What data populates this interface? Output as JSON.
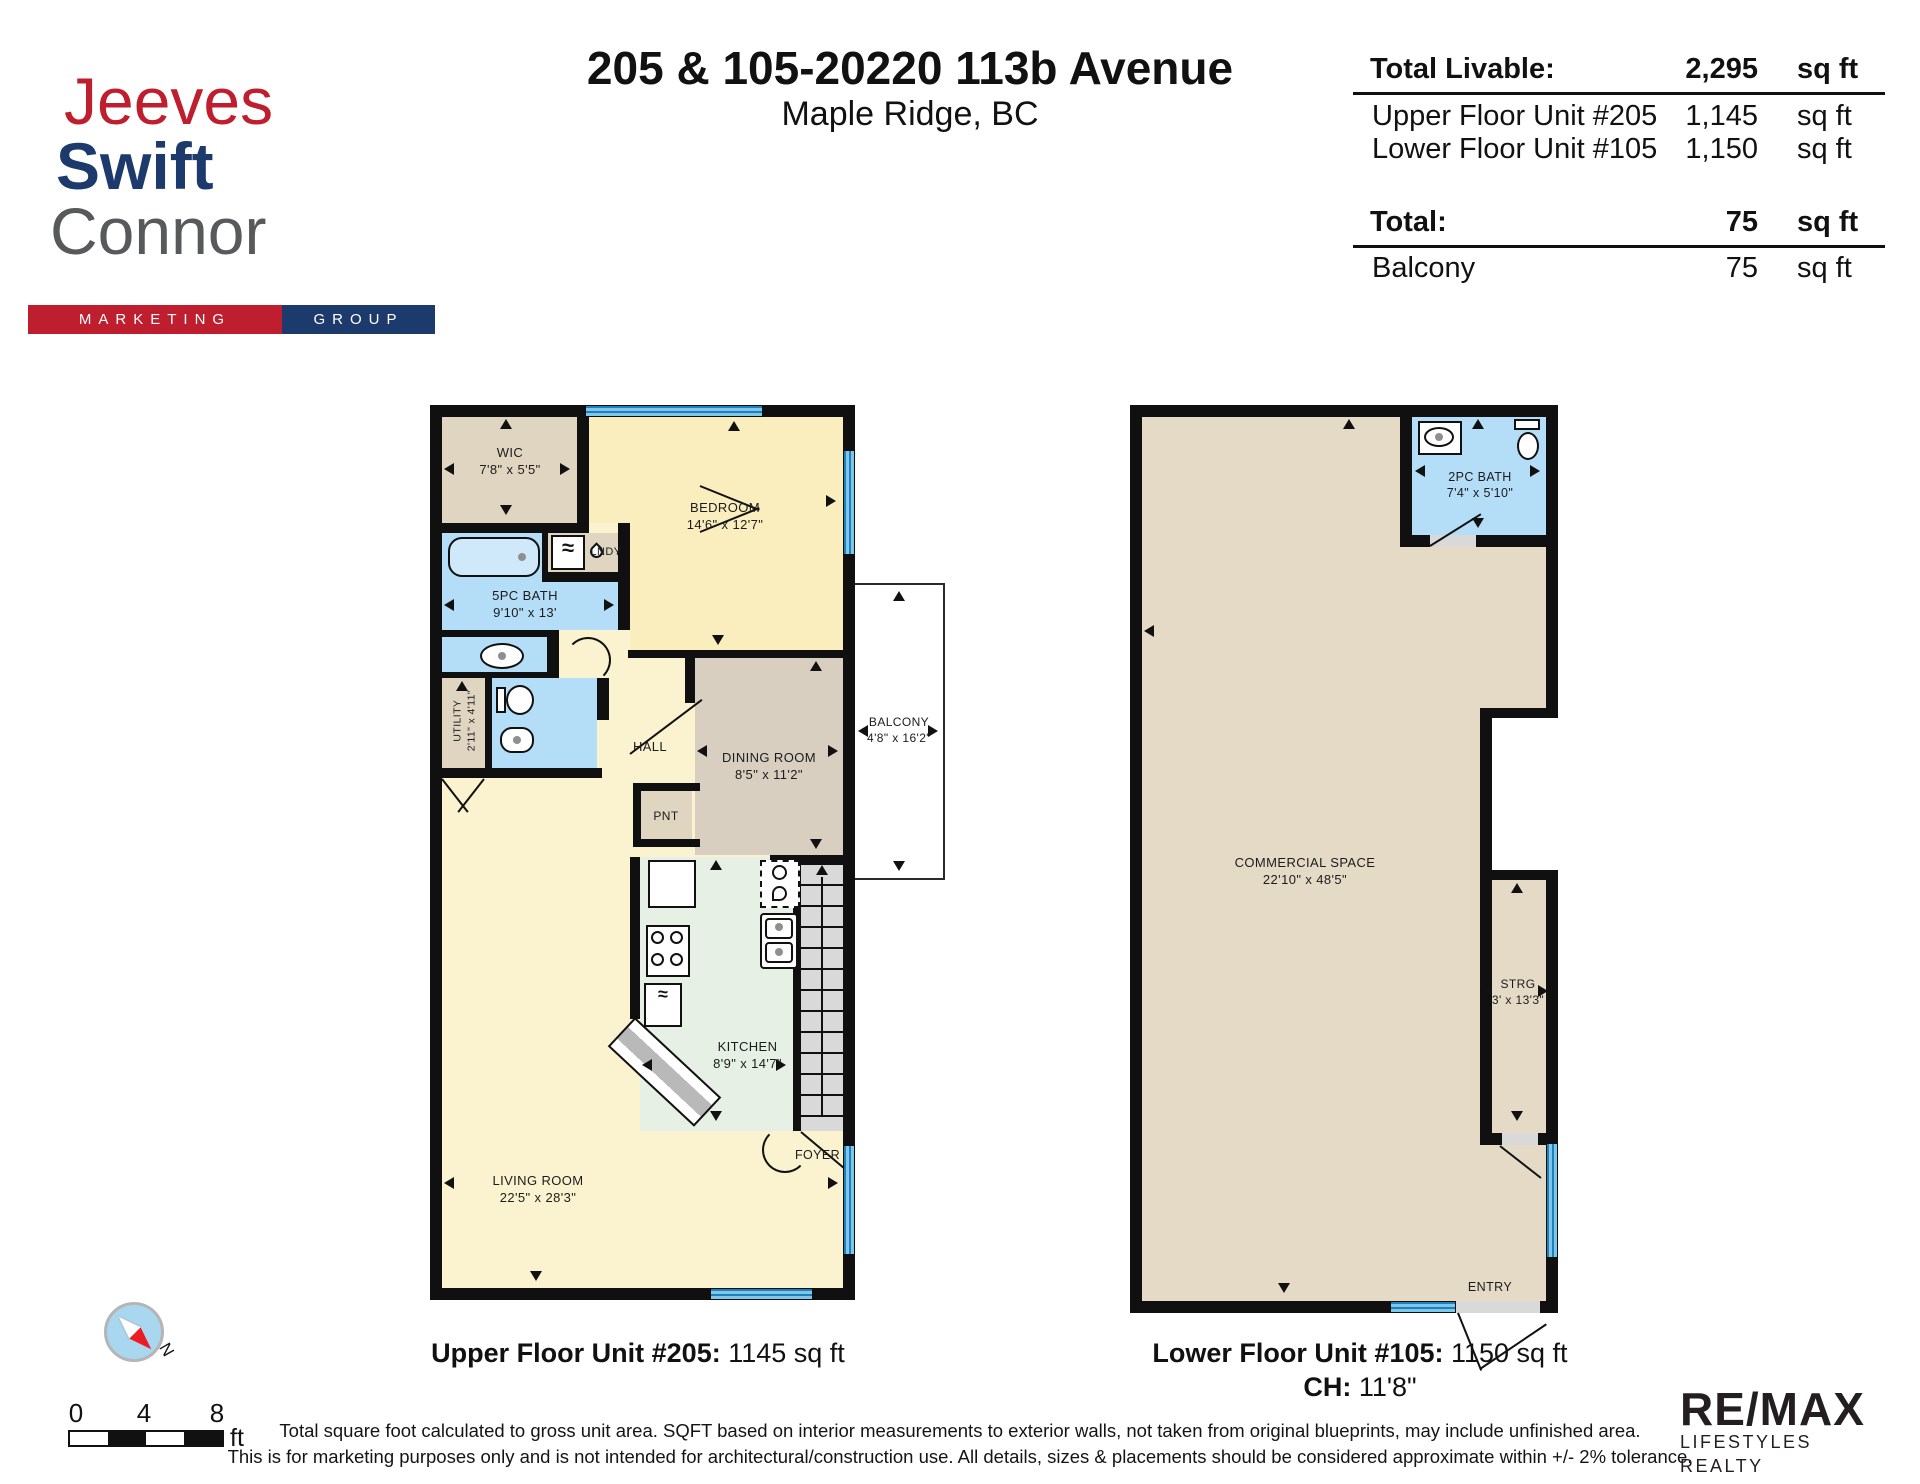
{
  "logo": {
    "line1": "Jeeves",
    "line2": "Swift",
    "line3": "Connor",
    "banner_left": "MARKETING",
    "banner_right": "GROUP"
  },
  "header": {
    "address": "205 & 105-20220 113b Avenue",
    "city": "Maple Ridge, BC"
  },
  "area_table": {
    "rows": [
      {
        "label": "Total Livable:",
        "value": "2,295",
        "unit": "sq ft"
      },
      {
        "label": "Upper Floor Unit #205",
        "value": "1,145",
        "unit": "sq ft"
      },
      {
        "label": "Lower Floor Unit #105",
        "value": "1,150",
        "unit": "sq ft"
      },
      {
        "label": "Total:",
        "value": "75",
        "unit": "sq ft"
      },
      {
        "label": "Balcony",
        "value": "75",
        "unit": "sq ft"
      }
    ]
  },
  "upper_plan": {
    "rooms": {
      "wic": {
        "name": "WIC",
        "dims": "7'8\" x 5'5\""
      },
      "bedroom": {
        "name": "BEDROOM",
        "dims": "14'6\" x 12'7\""
      },
      "bath5": {
        "name": "5PC BATH",
        "dims": "9'10\" x 13'"
      },
      "lndy": {
        "name": "LNDY"
      },
      "utility": {
        "name": "UTILITY",
        "dims": "2'11\" x 4'11\""
      },
      "hall": {
        "name": "HALL"
      },
      "dining": {
        "name": "DINING ROOM",
        "dims": "8'5\" x 11'2\""
      },
      "balcony": {
        "name": "BALCONY",
        "dims": "4'8\" x 16'2\""
      },
      "pnt": {
        "name": "PNT"
      },
      "kitchen": {
        "name": "KITCHEN",
        "dims": "8'9\" x 14'7\""
      },
      "foyer": {
        "name": "FOYER"
      },
      "living": {
        "name": "LIVING ROOM",
        "dims": "22'5\" x 28'3\""
      }
    },
    "caption": {
      "bold": "Upper Floor Unit #205:",
      "text": " 1145 sq ft"
    }
  },
  "lower_plan": {
    "rooms": {
      "commercial": {
        "name": "COMMERCIAL SPACE",
        "dims": "22'10\" x 48'5\""
      },
      "bath2": {
        "name": "2PC BATH",
        "dims": "7'4\" x 5'10\""
      },
      "strg": {
        "name": "STRG",
        "dims": "3' x 13'3\""
      },
      "entry": {
        "name": "ENTRY"
      }
    },
    "caption": {
      "bold": "Lower Floor Unit #105:",
      "text": " 1150 sq ft"
    },
    "ceiling": {
      "bold": "CH:",
      "text": " 11'8\""
    }
  },
  "footer": {
    "scale": {
      "n0": "0",
      "n4": "4",
      "n8": "8",
      "unit": "ft"
    },
    "compass_label": "N",
    "disclaimer_line1": "Total square foot calculated to gross unit area. SQFT based on interior measurements to exterior walls, not taken from original blueprints, may include unfinished area.",
    "disclaimer_line2": "This is for marketing purposes only and is not intended for architectural/construction use.  All details, sizes & placements should be considered approximate within +/- 2%  tolerance.",
    "remax_line1": "RE/MAX",
    "remax_line2": "LIFESTYLES REALTY"
  },
  "colors": {
    "logo_red": "#BE1E2D",
    "logo_navy": "#1D3A6D",
    "logo_gray": "#58595B",
    "wall": "#101010",
    "window_blue": "#4FA8D8",
    "bath_blue": "#B4DDF7",
    "bedroom_yellow": "#FAEDBE",
    "living_yellow": "#FBF2D0",
    "closet_beige": "#E0D5C1",
    "dining_tan": "#D9CFC0",
    "commercial_tan": "#E5DAC6",
    "kitchen_green": "#E7F0E5",
    "stair_gray": "#D9D9D9",
    "compass_red": "#ED1C24",
    "remax_dark": "#231F20"
  }
}
